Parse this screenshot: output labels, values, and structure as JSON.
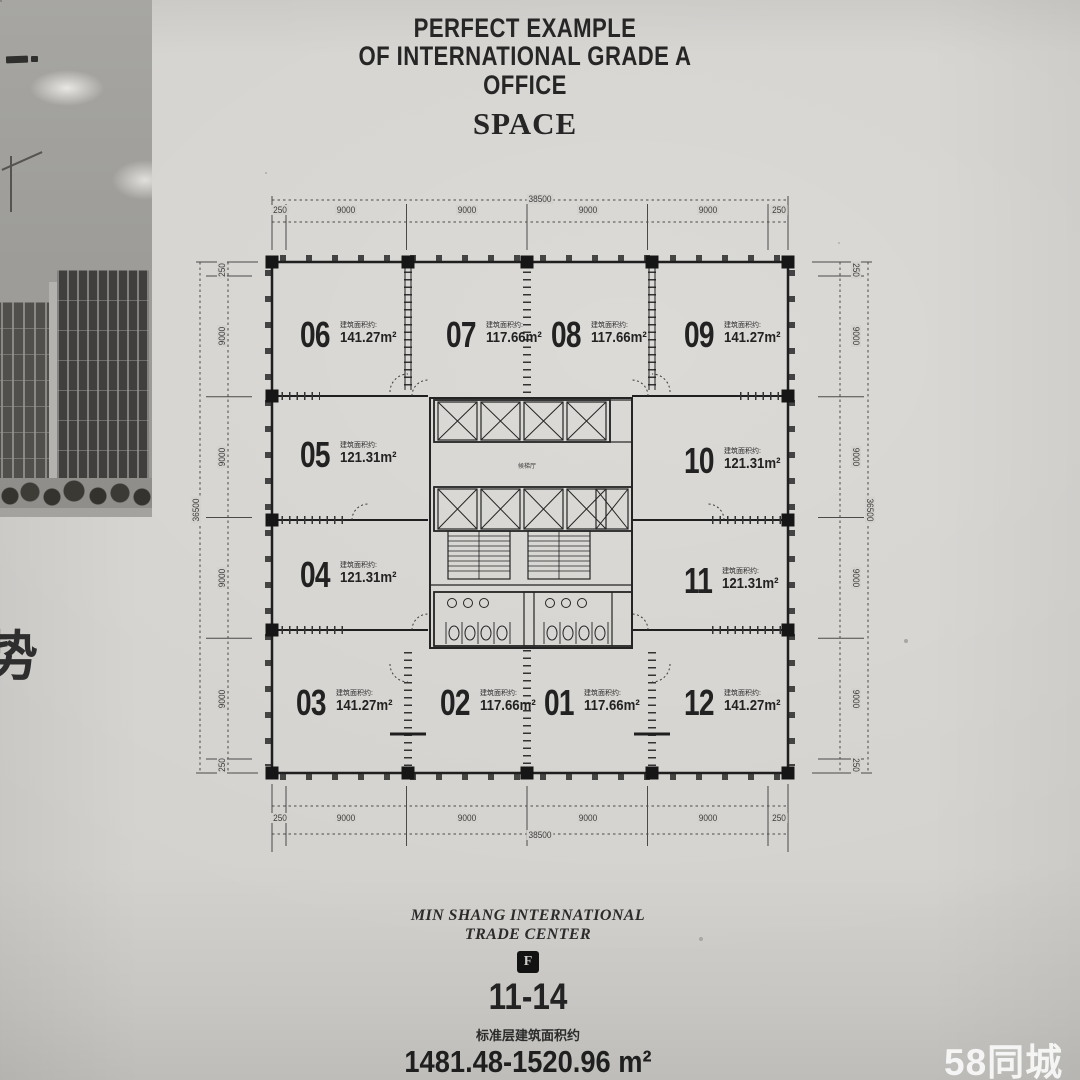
{
  "title": {
    "line1": "PERFECT EXAMPLE",
    "line2": "OF INTERNATIONAL GRADE A",
    "line3": "OFFICE",
    "line4": "SPACE"
  },
  "photo": {
    "side_char": "势"
  },
  "plan": {
    "area_prefix": "建筑面积约:",
    "units": [
      {
        "no": "06",
        "area": "141.27m²"
      },
      {
        "no": "07",
        "area": "117.66m²"
      },
      {
        "no": "08",
        "area": "117.66m²"
      },
      {
        "no": "09",
        "area": "141.27m²"
      },
      {
        "no": "05",
        "area": "121.31m²"
      },
      {
        "no": "10",
        "area": "121.31m²"
      },
      {
        "no": "04",
        "area": "121.31m²"
      },
      {
        "no": "11",
        "area": "121.31m²"
      },
      {
        "no": "03",
        "area": "141.27m²"
      },
      {
        "no": "02",
        "area": "117.66m²"
      },
      {
        "no": "01",
        "area": "117.66m²"
      },
      {
        "no": "12",
        "area": "141.27m²"
      }
    ],
    "core": {
      "lobby_label": "候梯厅"
    },
    "dimensions": {
      "horizontal_total": "38500",
      "vertical_total": "36500",
      "bay": "9000",
      "end": "250"
    }
  },
  "footer": {
    "brand_line1": "MIN SHANG INTERNATIONAL",
    "brand_line2": "TRADE CENTER",
    "logo_letter": "F",
    "floor_range": "11-14",
    "area_note": "标准层建筑面积约",
    "area_range": "1481.48-1520.96 m²"
  },
  "watermark": {
    "text": "58同城"
  }
}
